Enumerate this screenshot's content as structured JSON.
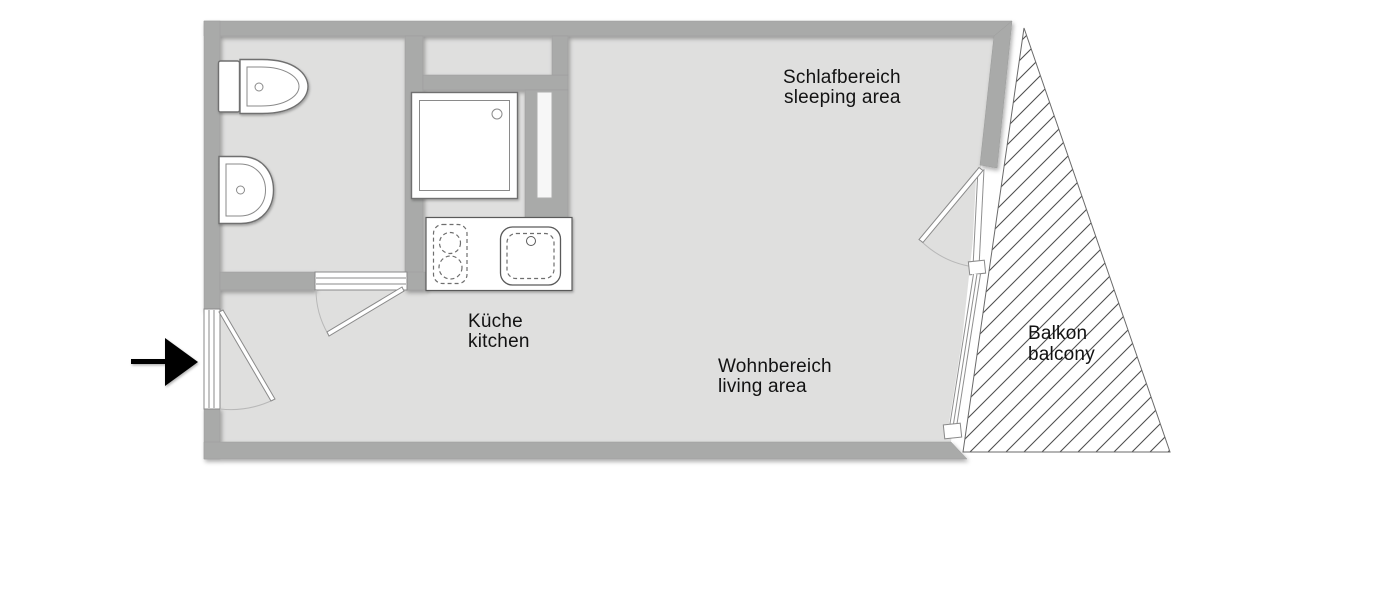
{
  "labels": {
    "sleeping_de": "Schlafbereich",
    "sleeping_en": "sleeping area",
    "kitchen_de": "Küche",
    "kitchen_en": "kitchen",
    "living_de": "Wohnbereich",
    "living_en": "living area",
    "balcony_de": "Balkon",
    "balcony_en": "balcony"
  },
  "icons": [
    "toilet",
    "washbasin",
    "shower-tray",
    "cooktop",
    "kitchen-sink",
    "entrance-arrow"
  ],
  "colors": {
    "wall": "#a9aaa9",
    "floor": "#dfdfde",
    "fixture_outline": "#6f6f6f",
    "hatch": "#4f4f4f",
    "text": "#121212",
    "arrow": "#000000",
    "background": "#ffffff"
  }
}
